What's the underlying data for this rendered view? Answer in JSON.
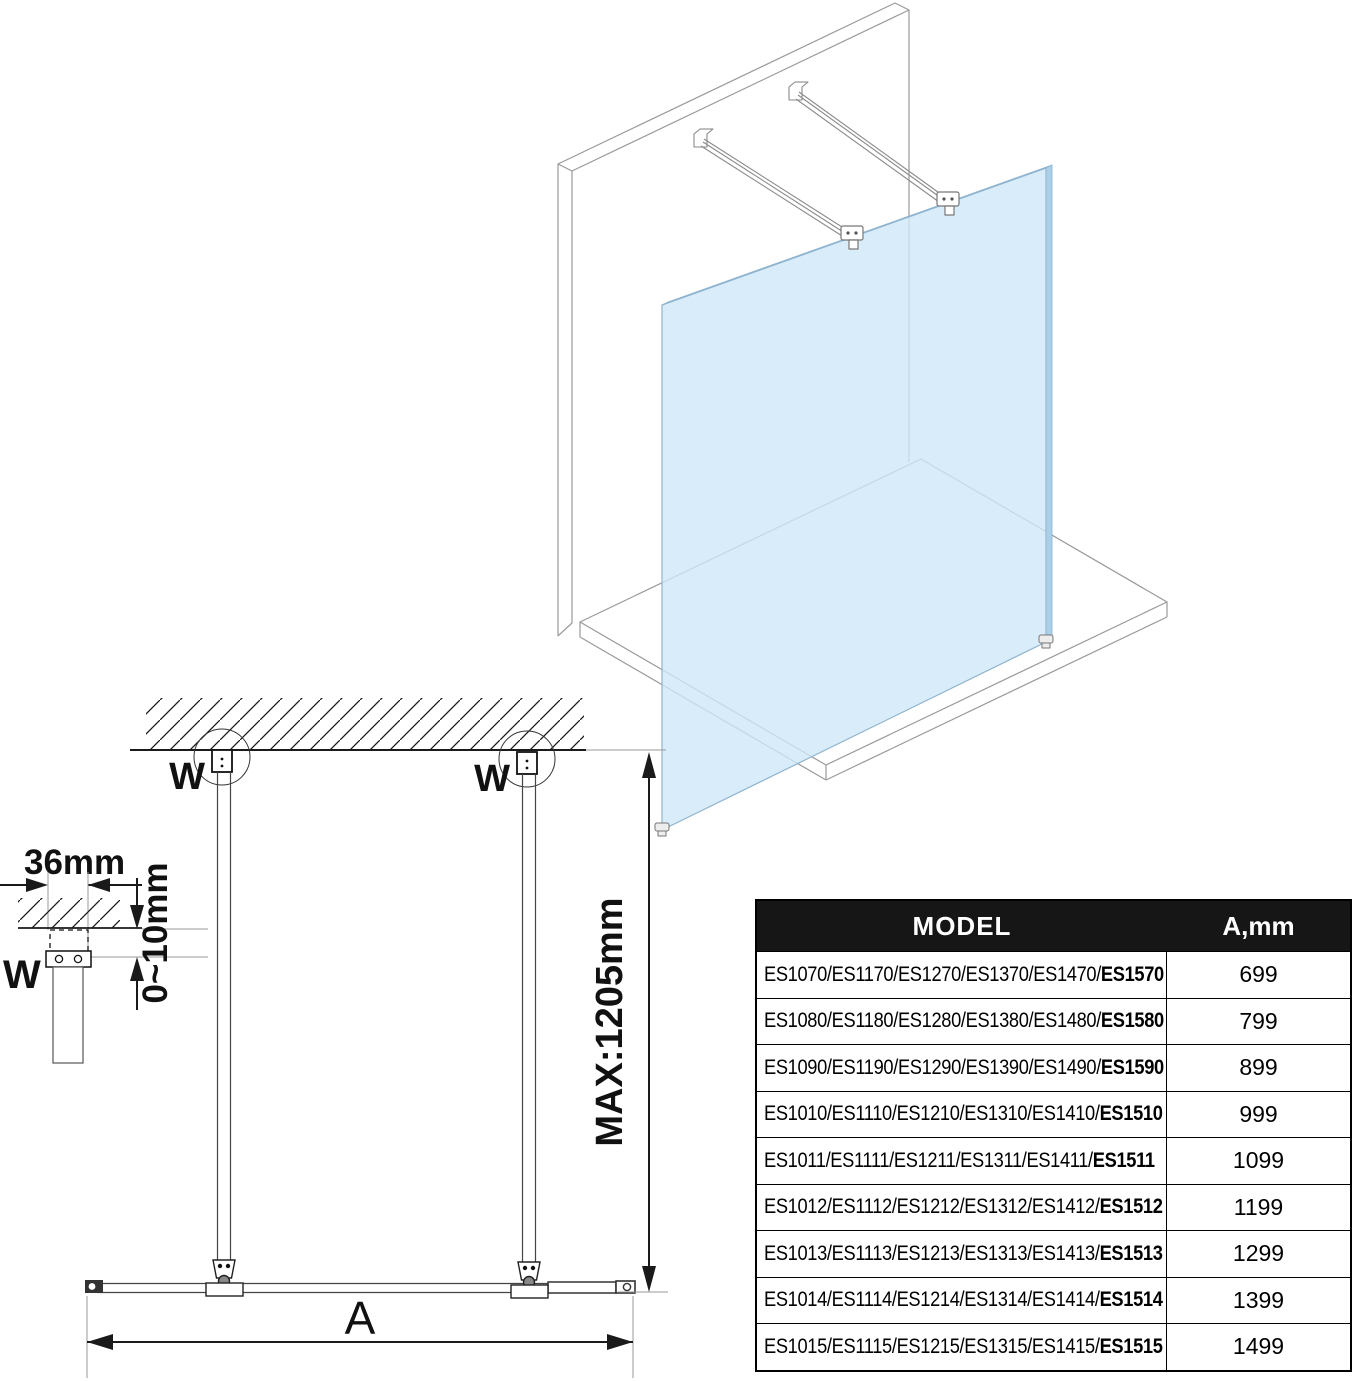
{
  "diagram": {
    "labels": {
      "dim_36mm": "36mm",
      "dim_0_10mm": "0~10mm",
      "dim_max": "MAX:1205mm",
      "dim_a": "A",
      "wall_fix_left": "W",
      "wall_fix_right": "W",
      "wall_fix_detail": "W"
    },
    "colors": {
      "glass": "#cfe7f7",
      "glass_edge": "#8fb4cf",
      "line_gray": "#9a9a9a",
      "line_dark": "#1a1a1a",
      "table_header_bg": "#161616"
    }
  },
  "table": {
    "headers": {
      "model": "MODEL",
      "a_mm": "A,mm"
    },
    "rows": [
      {
        "models": "ES1070/ES1170/ES1270/ES1370/ES1470/",
        "model_bold": "ES1570",
        "a_mm": "699"
      },
      {
        "models": "ES1080/ES1180/ES1280/ES1380/ES1480/",
        "model_bold": "ES1580",
        "a_mm": "799"
      },
      {
        "models": "ES1090/ES1190/ES1290/ES1390/ES1490/",
        "model_bold": "ES1590",
        "a_mm": "899"
      },
      {
        "models": "ES1010/ES1110/ES1210/ES1310/ES1410/",
        "model_bold": "ES1510",
        "a_mm": "999"
      },
      {
        "models": "ES1011/ES1111/ES1211/ES1311/ES1411/",
        "model_bold": "ES1511",
        "a_mm": "1099"
      },
      {
        "models": "ES1012/ES1112/ES1212/ES1312/ES1412/",
        "model_bold": "ES1512",
        "a_mm": "1199"
      },
      {
        "models": "ES1013/ES1113/ES1213/ES1313/ES1413/",
        "model_bold": "ES1513",
        "a_mm": "1299"
      },
      {
        "models": "ES1014/ES1114/ES1214/ES1314/ES1414/",
        "model_bold": "ES1514",
        "a_mm": "1399"
      },
      {
        "models": "ES1015/ES1115/ES1215/ES1315/ES1415/",
        "model_bold": "ES1515",
        "a_mm": "1499"
      }
    ]
  }
}
